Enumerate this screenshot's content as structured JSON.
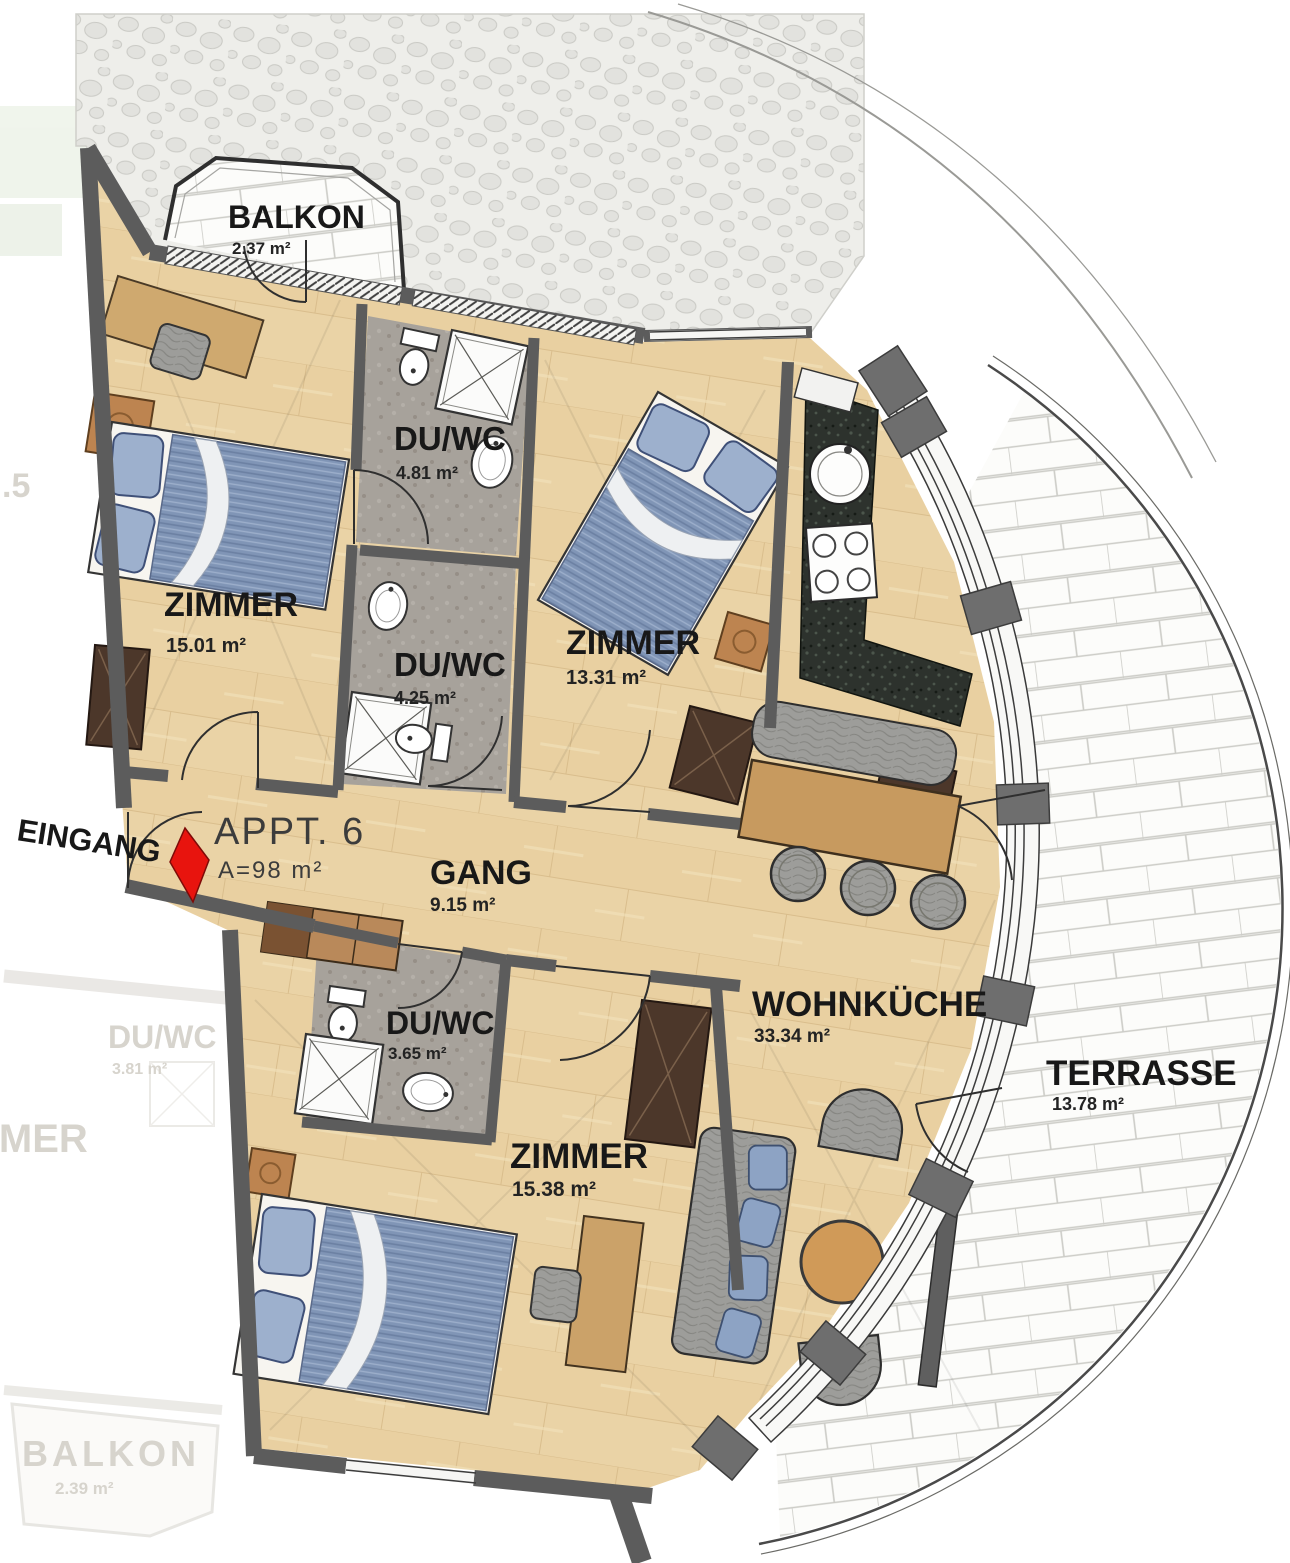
{
  "apartment": {
    "name": "APPT. 6",
    "area_total": "A=98 m²",
    "entrance_label": "EINGANG"
  },
  "rooms": {
    "balkon": {
      "label": "BALKON",
      "area": "2.37 m²"
    },
    "zimmer_nw": {
      "label": "ZIMMER",
      "area": "15.01 m²"
    },
    "duwc_top": {
      "label": "DU/WC",
      "area": "4.81 m²"
    },
    "duwc_mid": {
      "label": "DU/WC",
      "area": "4.25 m²"
    },
    "zimmer_ne": {
      "label": "ZIMMER",
      "area": "13.31 m²"
    },
    "gang": {
      "label": "GANG",
      "area": "9.15 m²"
    },
    "duwc_low": {
      "label": "DU/WC",
      "area": "3.65 m²"
    },
    "zimmer_s": {
      "label": "ZIMMER",
      "area": "15.38 m²"
    },
    "wohnkueche": {
      "label": "WOHNKÜCHE",
      "area": "33.34 m²"
    },
    "terrasse": {
      "label": "TERRASSE",
      "area": "13.78 m²"
    }
  },
  "neighbor_faded": {
    "appt_number_fragment": ".5",
    "duwc": {
      "label": "DU/WC",
      "area": "3.81 m²"
    },
    "zimmer": {
      "label": "ZIMMER"
    },
    "balkon": {
      "label": "BALKON",
      "area": "2.39 m²"
    }
  },
  "colors": {
    "wall": "#5c5c5c",
    "wood_floor": "#e9d2a4",
    "bath_floor": "#a6a19a",
    "kitchen_counter": "#2c312c",
    "entrance_arrow": "#e8140e",
    "mattress_blue": "#8095b6",
    "fabric_gray": "#9d9d9a",
    "wood_furniture": "#c79a5f",
    "dark_furniture": "#4c372a",
    "brick_line": "#ccccc7"
  }
}
